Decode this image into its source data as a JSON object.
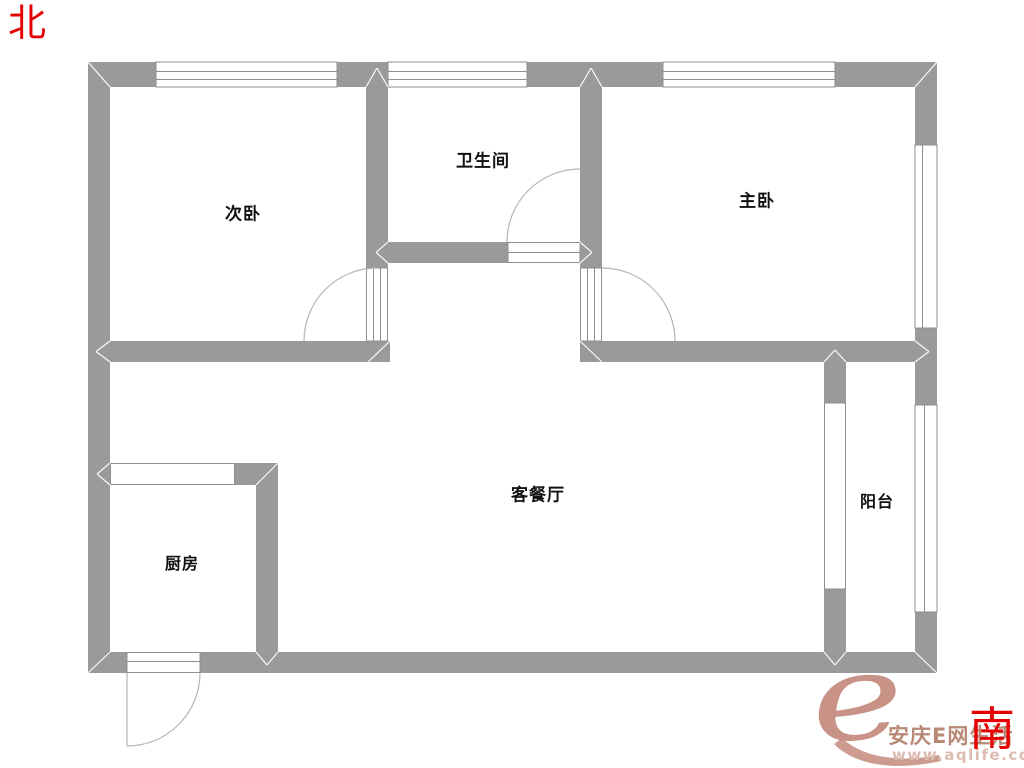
{
  "compass": {
    "north_label": "北",
    "south_label": "南"
  },
  "rooms": {
    "secondary_bedroom": "次卧",
    "bathroom": "卫生间",
    "master_bedroom": "主卧",
    "living_dining_room": "客餐厅",
    "kitchen": "厨房",
    "balcony": "阳台"
  },
  "watermark": {
    "logo_letter": "e",
    "site_name": "安庆E网生活",
    "site_url": "www.aqlife.com"
  },
  "colors": {
    "wall_gray": "#9a9a9a",
    "outline_gray": "#8f8f8f",
    "door_arc_gray": "#b5b5b5",
    "compass_red": "#e60000",
    "room_label_black": "#111111",
    "watermark_rose": "#c4897c",
    "watermark_text_brown": "#b5836f",
    "watermark_url_pink": "#ddbbb1"
  }
}
